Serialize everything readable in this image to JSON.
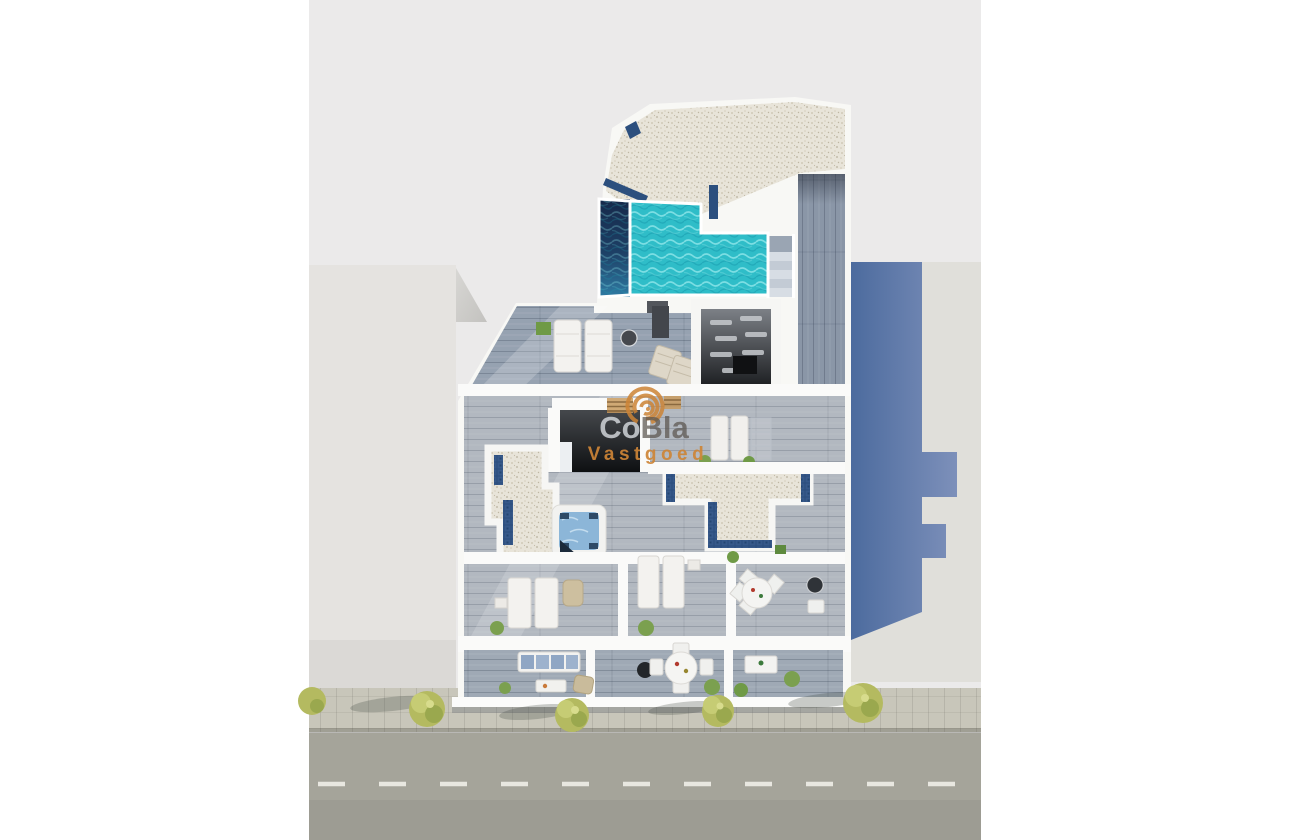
{
  "watermark": {
    "brand_co": "Co",
    "brand_bla": "Bla",
    "tagline": "Vastgoed",
    "accent_orange": "#cd8436",
    "brand_gray_light": "#dee2e6",
    "brand_gray_dark": "#5a554e"
  },
  "scene": {
    "type": "aerial-3d-floorplan-render",
    "areas": [
      "rooftop-gravel-terrace",
      "rooftop-pool",
      "pool-stairs",
      "side-walkway",
      "solarium-terrace-with-sunloungers",
      "louvered-pergola-room",
      "stairwell-opening",
      "skylight-gravel-patch",
      "jacuzzi",
      "central-gravel-skylight",
      "lounge-rooms",
      "dining-room",
      "front-balconies",
      "sidewalk-with-trees",
      "street"
    ],
    "palette": {
      "render_background": "#ebeaea",
      "building_white": "#f8f8f5",
      "pool_turquoise": "#2fbdc8",
      "pool_deep_navy": "#1d4066",
      "tile_mosaic_blue": "#2c4f7e",
      "deck_gray_blue": "#96a2b1",
      "gravel_beige": "#e8e4d9",
      "neighbor_gray": "#e4e2df",
      "shadow_wall_blue": "#5b79ab",
      "asphalt": "#a5a49a",
      "sidewalk": "#c8c6ba",
      "tree_green": "#b4ba60",
      "jacuzzi_water": "#8cb6d8"
    }
  }
}
